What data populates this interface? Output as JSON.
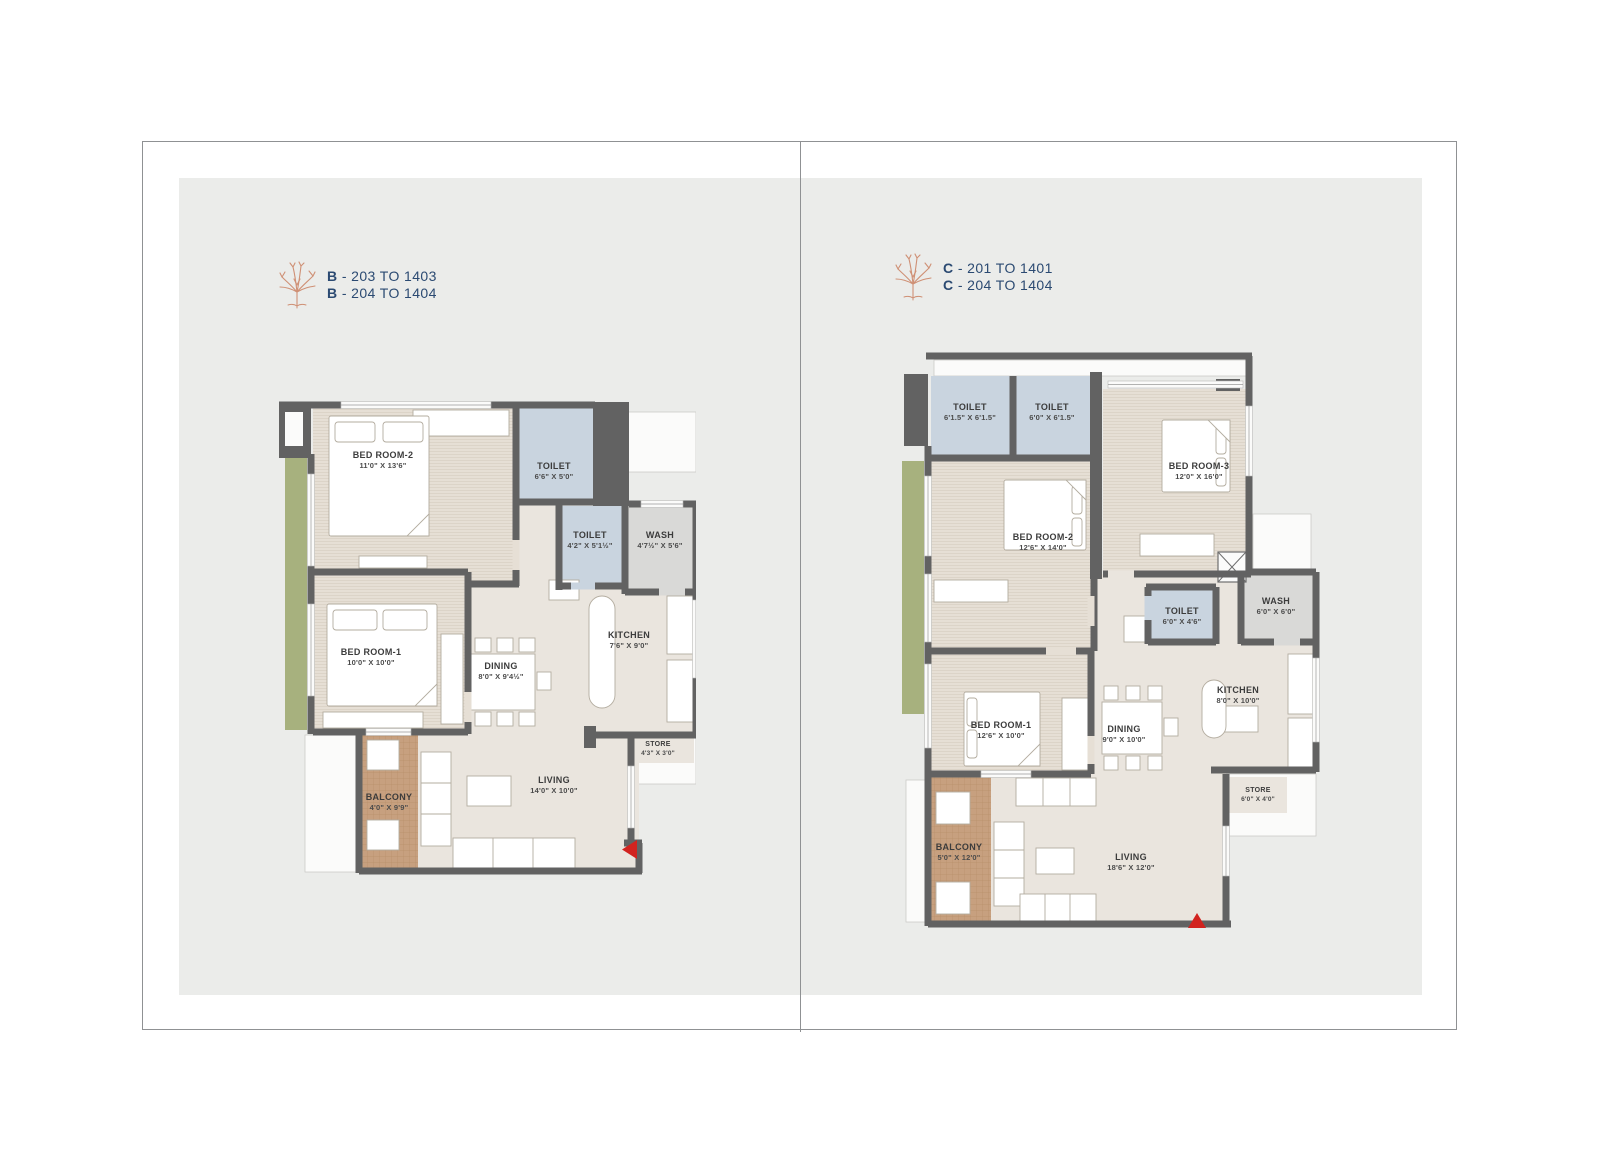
{
  "headers": {
    "left": {
      "lines": [
        {
          "unit": "B",
          "range": "- 203 TO 1403"
        },
        {
          "unit": "B",
          "range": "- 204 TO 1404"
        }
      ]
    },
    "right": {
      "lines": [
        {
          "unit": "C",
          "range": "- 201 TO 1401"
        },
        {
          "unit": "C",
          "range": "- 204 TO 1404"
        }
      ]
    }
  },
  "plans": {
    "b": {
      "rooms": {
        "bedroom2": {
          "name": "BED ROOM-2",
          "dims": "11'0\" X 13'6\""
        },
        "toilet_top": {
          "name": "TOILET",
          "dims": "6'6\" X 5'0\""
        },
        "toilet_mid": {
          "name": "TOILET",
          "dims": "4'2\" X 5'1½\""
        },
        "wash": {
          "name": "WASH",
          "dims": "4'7½\" X 5'6\""
        },
        "bedroom1": {
          "name": "BED ROOM-1",
          "dims": "10'0\" X 10'0\""
        },
        "dining": {
          "name": "DINING",
          "dims": "8'0\" X 9'4½\""
        },
        "kitchen": {
          "name": "KITCHEN",
          "dims": "7'6\" X 9'0\""
        },
        "store": {
          "name": "STORE",
          "dims": "4'3\" X 3'0\""
        },
        "balcony": {
          "name": "BALCONY",
          "dims": "4'0\" X 9'9\""
        },
        "living": {
          "name": "LIVING",
          "dims": "14'0\" X 10'0\""
        }
      }
    },
    "c": {
      "rooms": {
        "toilet1": {
          "name": "TOILET",
          "dims": "6'1.5\" X 6'1.5\""
        },
        "toilet2": {
          "name": "TOILET",
          "dims": "6'0\" X 6'1.5\""
        },
        "bedroom3": {
          "name": "BED ROOM-3",
          "dims": "12'0\" X 16'0\""
        },
        "bedroom2": {
          "name": "BED ROOM-2",
          "dims": "12'6\" X 14'0\""
        },
        "toilet_mid": {
          "name": "TOILET",
          "dims": "6'0\" X 4'6\""
        },
        "wash": {
          "name": "WASH",
          "dims": "6'0\" X 6'0\""
        },
        "bedroom1": {
          "name": "BED ROOM-1",
          "dims": "12'6\" X 10'0\""
        },
        "dining": {
          "name": "DINING",
          "dims": "9'0\" X 10'0\""
        },
        "kitchen": {
          "name": "KITCHEN",
          "dims": "8'0\" X 10'0\""
        },
        "store": {
          "name": "STORE",
          "dims": "6'0\" X 4'0\""
        },
        "balcony": {
          "name": "BALCONY",
          "dims": "5'0\" X 12'0\""
        },
        "living": {
          "name": "LIVING",
          "dims": "18'6\" X 12'0\""
        }
      }
    }
  },
  "colors": {
    "wall": "#626262",
    "bedroom_floor": "#e6dfd5",
    "open_floor": "#eae5de",
    "toilet": "#c9d4df",
    "wash": "#d9d9d7",
    "balcony": "#c7a07f",
    "planter": "#a7b17e",
    "panel": "#ebecea",
    "header_text": "#2b4a72",
    "tree_icon": "#cf9075",
    "entry_arrow": "#d2231f"
  }
}
